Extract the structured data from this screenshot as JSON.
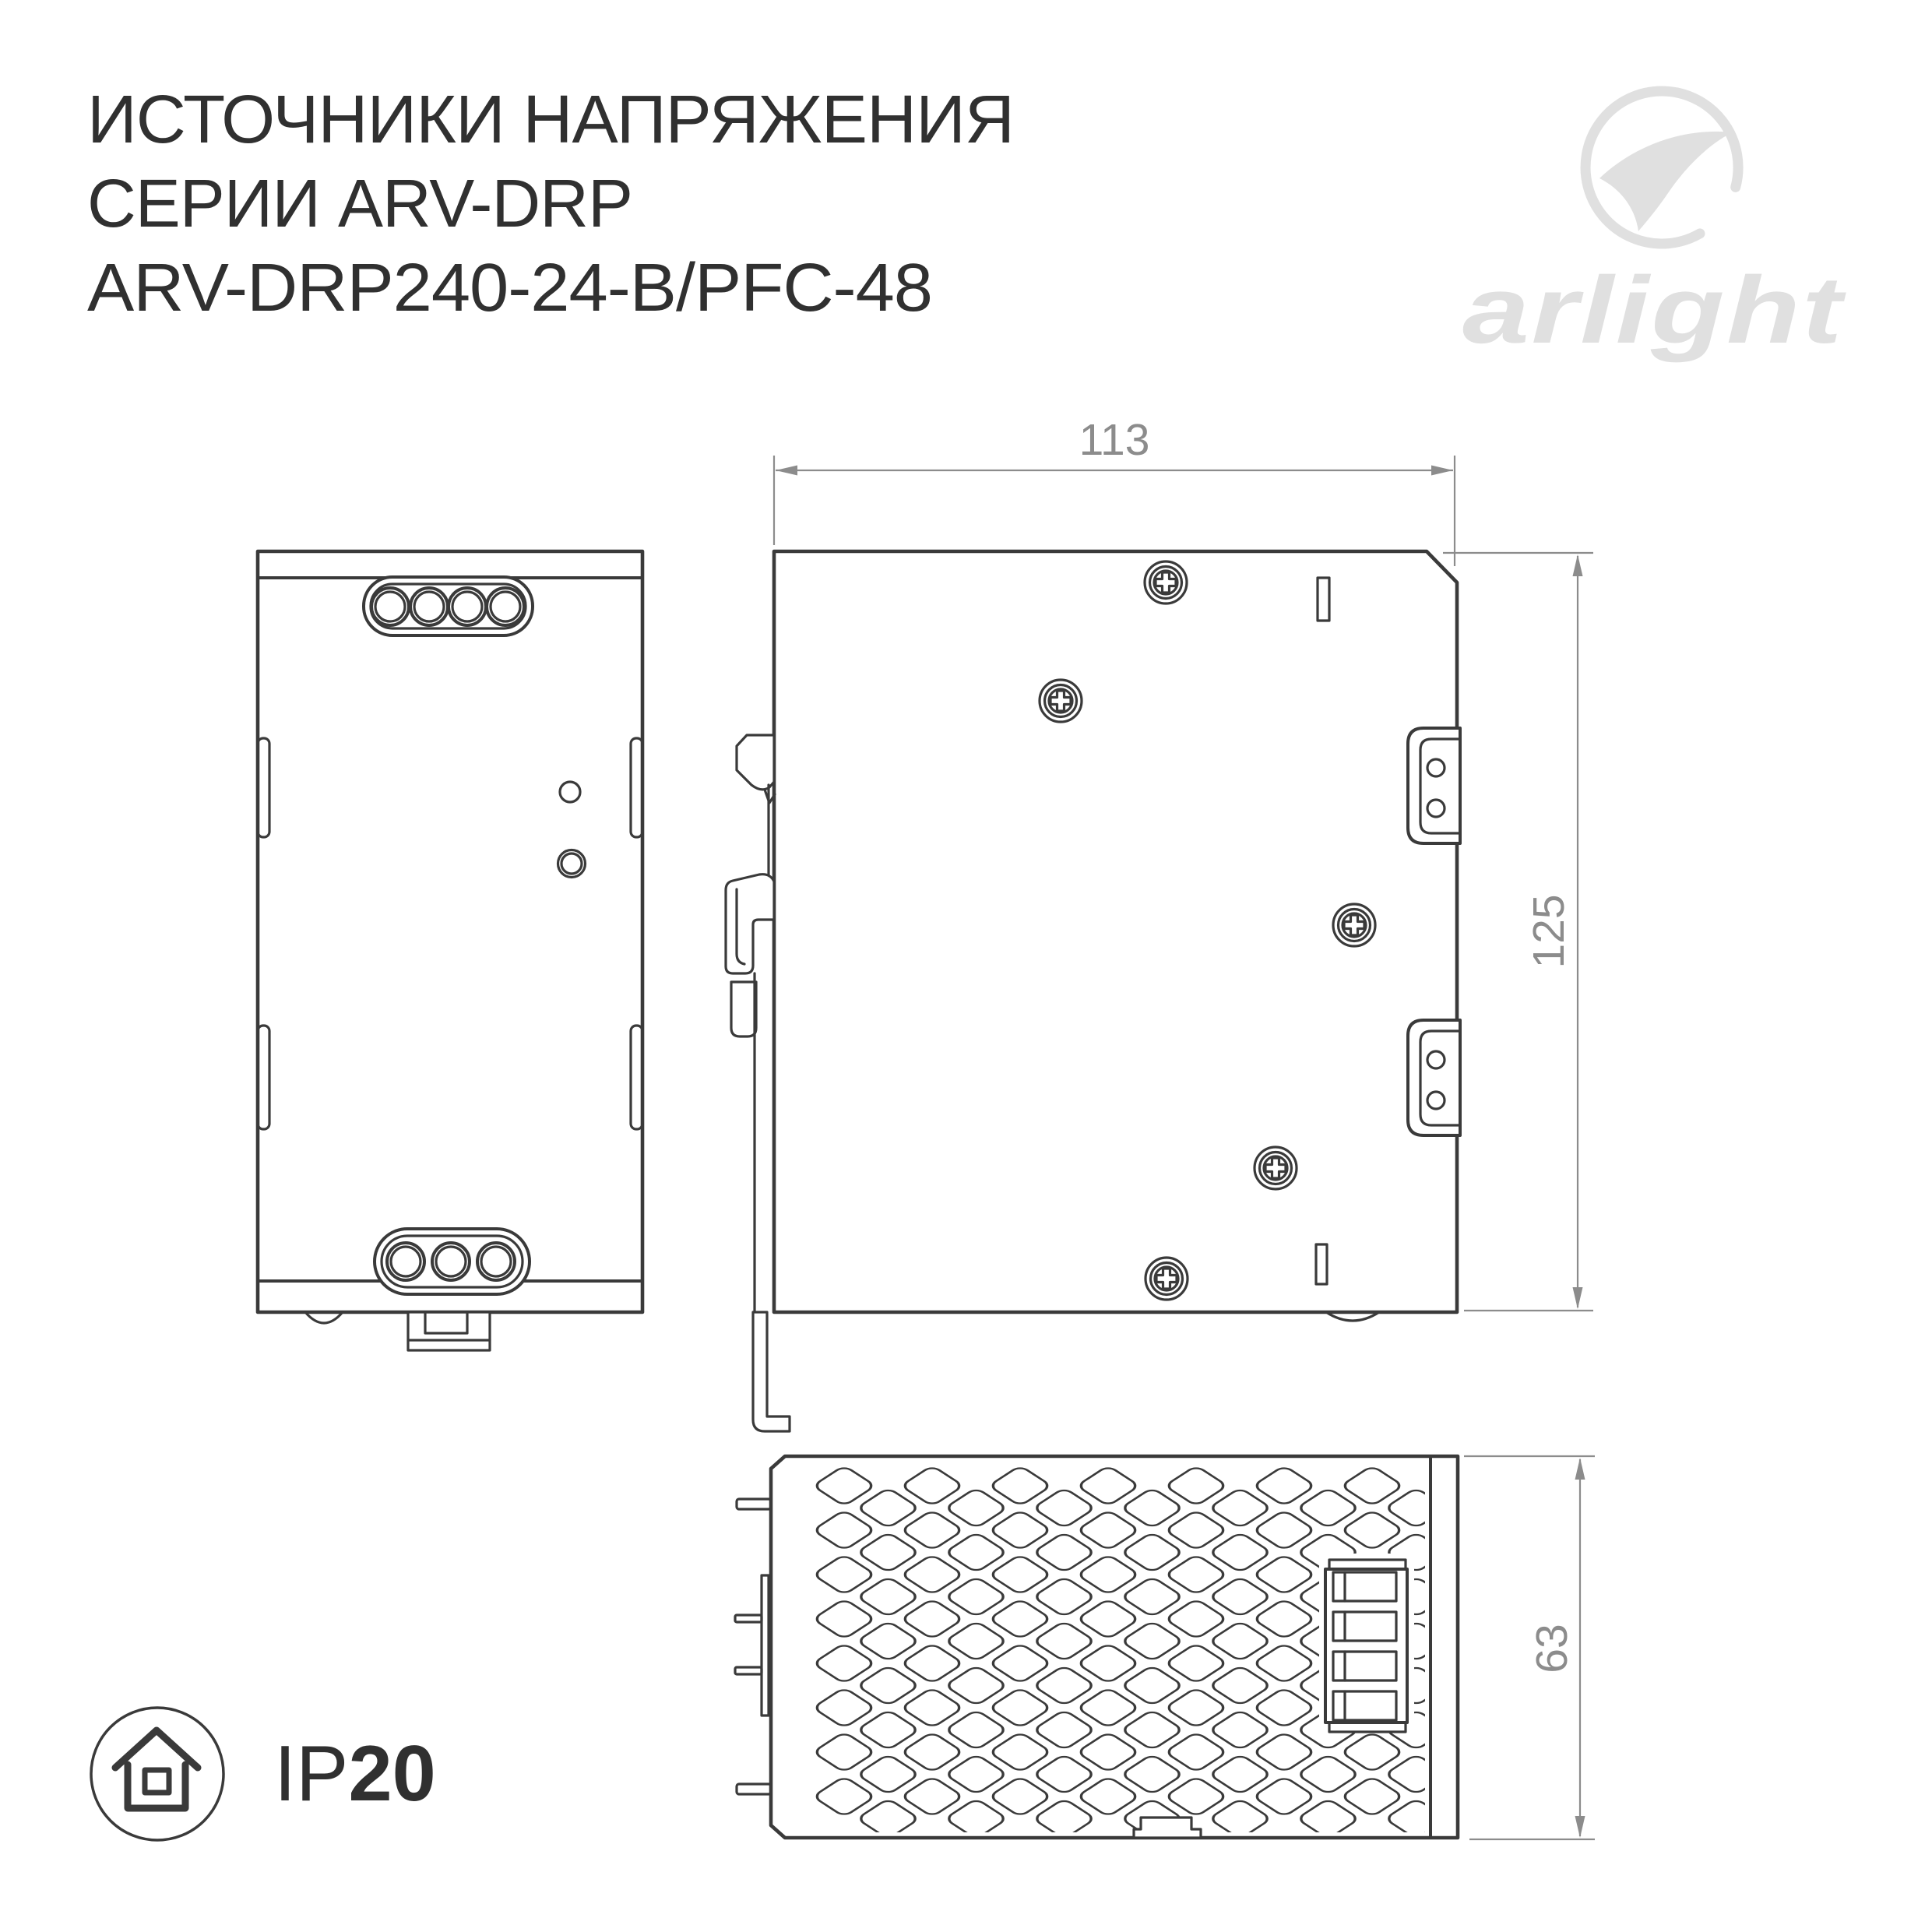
{
  "title": {
    "line1": "ИСТОЧНИКИ НАПРЯЖЕНИЯ",
    "line2": "СЕРИИ ARV-DRP",
    "line3": "ARV-DRP240-24-B/PFC-48"
  },
  "logo": {
    "wordmark": "arlight"
  },
  "views": {
    "side": {
      "width_label": "113",
      "height_label": "125"
    },
    "bottom": {
      "depth_label": "63"
    }
  },
  "ip_rating": {
    "prefix": "IP",
    "value": "20"
  },
  "icons": {
    "indoor_use": "house-in-circle-icon",
    "screw": "phillips-screw-head-icon",
    "logo_mark": "arlight-swoosh-circle-icon"
  },
  "colors": {
    "line": "#3a3a3a",
    "dimension": "#8c8c8c",
    "logo_gray": "#e0e0e0",
    "title_text": "#303030"
  }
}
